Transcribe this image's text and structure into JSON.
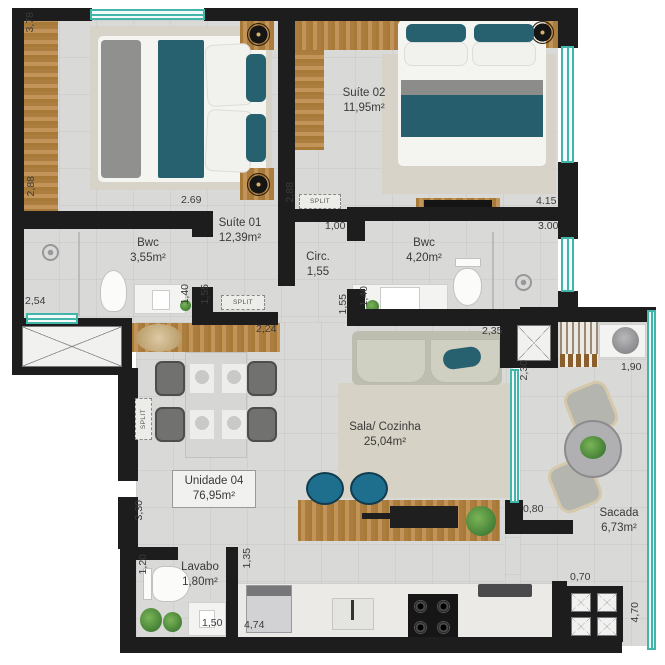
{
  "rooms": {
    "suite01": {
      "name": "Suíte 01",
      "area": "12,39m²"
    },
    "suite02": {
      "name": "Suíte 02",
      "area": "11,95m²"
    },
    "bwc01": {
      "name": "Bwc",
      "area": "3,55m²"
    },
    "bwc02": {
      "name": "Bwc",
      "area": "4,20m²"
    },
    "circ": {
      "name": "Circ.",
      "area": "1,55"
    },
    "sala": {
      "name": "Sala/ Cozinha",
      "area": "25,04m²"
    },
    "unidade": {
      "name": "Unidade 04",
      "area": "76,95m²"
    },
    "lavabo": {
      "name": "Lavabo",
      "area": "1,80m²"
    },
    "sacada": {
      "name": "Sacada",
      "area": "6,73m²"
    }
  },
  "dims": {
    "suite01_left_top": "3,78",
    "suite01_left_bottom": "2,88",
    "suite01_width": "2.69",
    "bwc01_window": "2,54",
    "bwc01_a": "1,40",
    "bwc01_b": "1,55",
    "circ_left": "2,88",
    "circ_top": "1,00",
    "suite02_width": "4.15",
    "bwc02_width": "3.00",
    "bwc02_a": "1,40",
    "bwc02_b": "1,55",
    "sofa_wall": "2,35",
    "sideboard": "2,24",
    "sacada_left": "2,30",
    "sacada_top": "1,90",
    "island_pass": "0,80",
    "living_left": "3,30",
    "lavabo_left": "1,20",
    "lavabo_right": "1,35",
    "lavabo_width": "1,50",
    "kitchen_width": "4,74",
    "sacada_step": "0,70",
    "sacada_right": "4,70"
  },
  "labels": {
    "split": "SPLIT"
  },
  "colors": {
    "wall": "#1d1d1d",
    "window_teal": "#43b6ac",
    "fabric_teal": "#27606f",
    "wood": "#b2824a",
    "stool_blue": "#1e6f8e"
  }
}
